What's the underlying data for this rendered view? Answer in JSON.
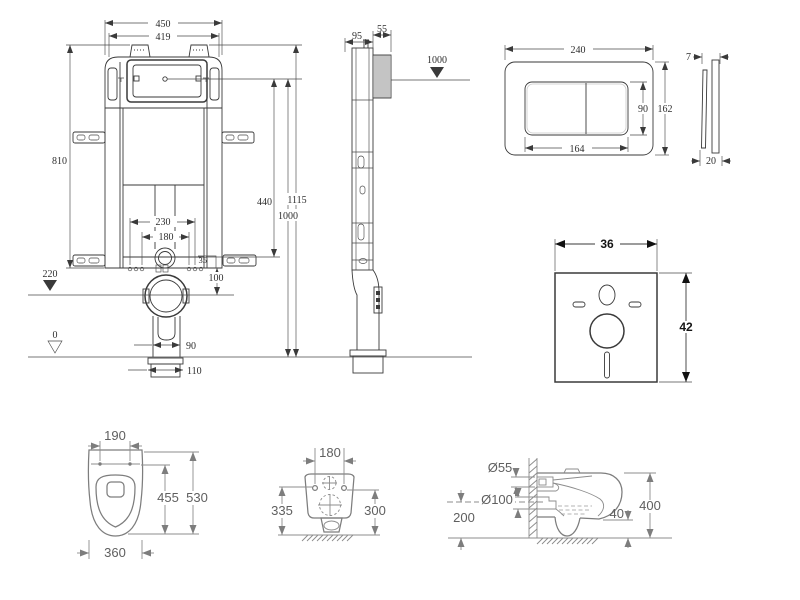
{
  "colors": {
    "background": "#ffffff",
    "line": "#3a3a3a",
    "soft_line": "#7d7d7d",
    "text": "#2e2e2e",
    "soft_text": "#5f5f5f"
  },
  "views": {
    "cistern_front": {
      "dims": {
        "outer_width": "450",
        "inner_width": "419",
        "frame_height": "810",
        "flush_drop": "440",
        "total_height": "1115",
        "button_height": "1000",
        "bolt_span_outer": "230",
        "bolt_span_inner": "180",
        "offset": "35",
        "outlet_offset": "100",
        "outlet_level": "220",
        "floor_level": "0",
        "pipe_width": "90",
        "flange_width": "110"
      }
    },
    "cistern_side": {
      "dims": {
        "frame_depth": "95",
        "hose_depth": "55",
        "level": "1000"
      }
    },
    "flush_plate_front": {
      "dims": {
        "width": "240",
        "button_width": "164",
        "button_height": "90",
        "height": "162"
      }
    },
    "flush_plate_side": {
      "dims": {
        "thickness": "7",
        "depth": "20"
      }
    },
    "sound_mat": {
      "dims": {
        "width": "36",
        "height": "42"
      }
    },
    "toilet_top": {
      "dims": {
        "hole_spacing": "190",
        "seat_depth": "455",
        "total_depth": "530",
        "width": "360"
      }
    },
    "toilet_rear": {
      "dims": {
        "hole_spacing": "180",
        "left_height": "335",
        "right_height": "300"
      }
    },
    "toilet_side": {
      "dims": {
        "inlet_diameter": "Ø55",
        "outlet_diameter": "Ø100",
        "outlet_height": "200",
        "bottom_gap": "40",
        "height": "400"
      }
    }
  }
}
